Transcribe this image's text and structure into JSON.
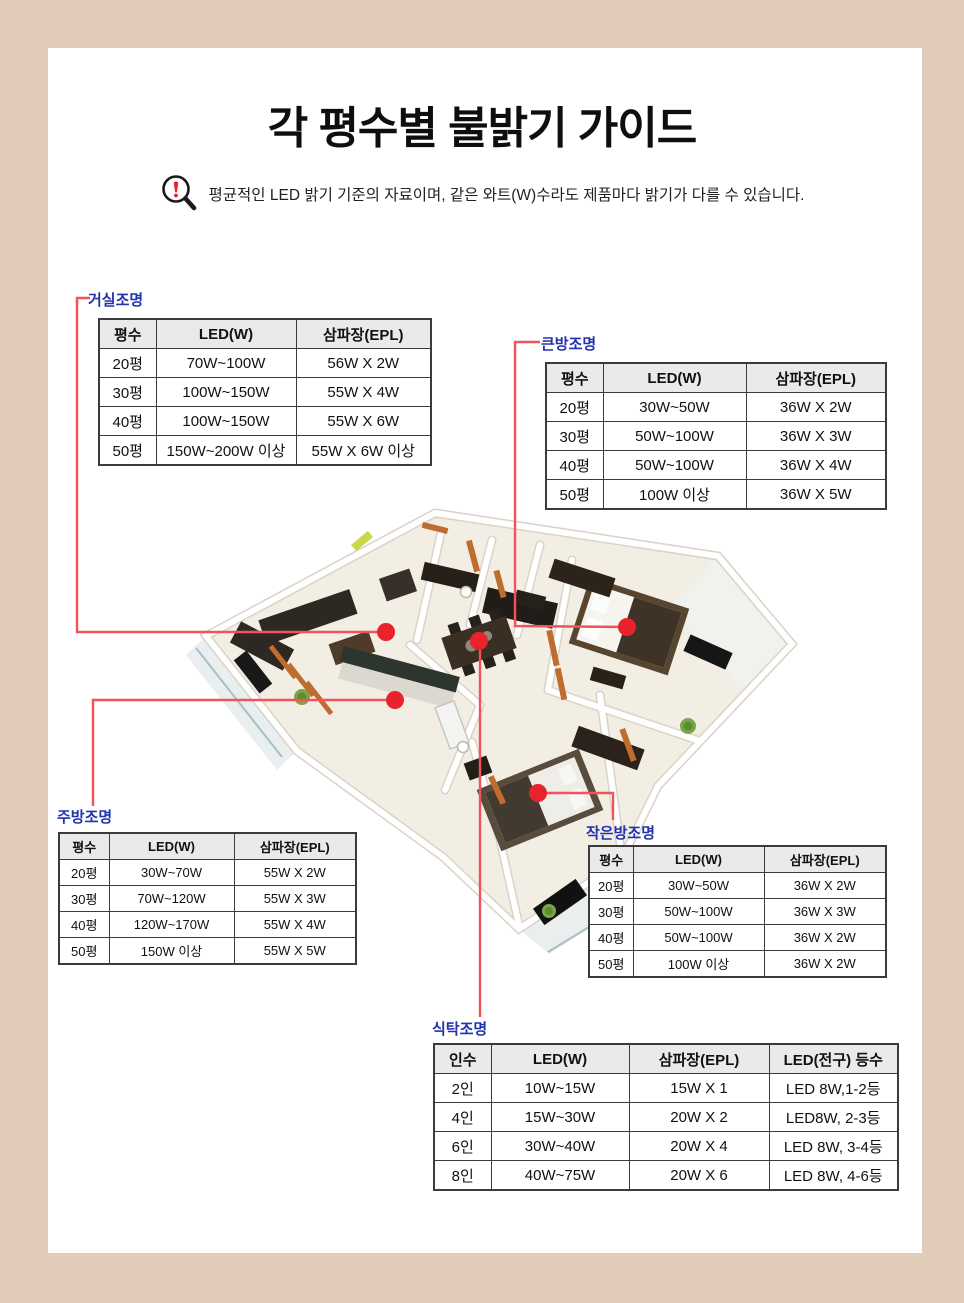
{
  "page": {
    "title": "각 평수별 불밝기 가이드",
    "notice": "평균적인 LED 밝기 기준의 자료이며, 같은 와트(W)수라도 제품마다 밝기가 다를 수 있습니다.",
    "colors": {
      "frame": "#e1ccba",
      "label_blue": "#2134ad",
      "connector_red": "#f0545a",
      "dot_red": "#e8232b",
      "table_header_bg": "#eaeaea",
      "table_border": "#3b3b3b"
    },
    "icons": {
      "notice_icon": "magnifier-exclamation-icon"
    }
  },
  "tables": {
    "living": {
      "label": "거실조명",
      "headers": [
        "평수",
        "LED(W)",
        "삼파장(EPL)"
      ],
      "rows": [
        [
          "20평",
          "70W~100W",
          "56W X 2W"
        ],
        [
          "30평",
          "100W~150W",
          "55W X 4W"
        ],
        [
          "40평",
          "100W~150W",
          "55W X 6W"
        ],
        [
          "50평",
          "150W~200W 이상",
          "55W X 6W 이상"
        ]
      ]
    },
    "big_room": {
      "label": "큰방조명",
      "headers": [
        "평수",
        "LED(W)",
        "삼파장(EPL)"
      ],
      "rows": [
        [
          "20평",
          "30W~50W",
          "36W X 2W"
        ],
        [
          "30평",
          "50W~100W",
          "36W X 3W"
        ],
        [
          "40평",
          "50W~100W",
          "36W X 4W"
        ],
        [
          "50평",
          "100W 이상",
          "36W X 5W"
        ]
      ]
    },
    "kitchen": {
      "label": "주방조명",
      "headers": [
        "평수",
        "LED(W)",
        "삼파장(EPL)"
      ],
      "rows": [
        [
          "20평",
          "30W~70W",
          "55W X 2W"
        ],
        [
          "30평",
          "70W~120W",
          "55W X 3W"
        ],
        [
          "40평",
          "120W~170W",
          "55W X 4W"
        ],
        [
          "50평",
          "150W 이상",
          "55W X 5W"
        ]
      ]
    },
    "small_room": {
      "label": "작은방조명",
      "headers": [
        "평수",
        "LED(W)",
        "삼파장(EPL)"
      ],
      "rows": [
        [
          "20평",
          "30W~50W",
          "36W X 2W"
        ],
        [
          "30평",
          "50W~100W",
          "36W X 3W"
        ],
        [
          "40평",
          "50W~100W",
          "36W X 2W"
        ],
        [
          "50평",
          "100W 이상",
          "36W X 2W"
        ]
      ]
    },
    "dining": {
      "label": "식탁조명",
      "headers": [
        "인수",
        "LED(W)",
        "삼파장(EPL)",
        "LED(전구) 등수"
      ],
      "rows": [
        [
          "2인",
          "10W~15W",
          "15W X 1",
          "LED 8W,1-2등"
        ],
        [
          "4인",
          "15W~30W",
          "20W X 2",
          "LED8W, 2-3등"
        ],
        [
          "6인",
          "30W~40W",
          "20W X 4",
          "LED 8W, 3-4등"
        ],
        [
          "8인",
          "40W~75W",
          "20W X 6",
          "LED 8W, 4-6등"
        ]
      ]
    }
  }
}
